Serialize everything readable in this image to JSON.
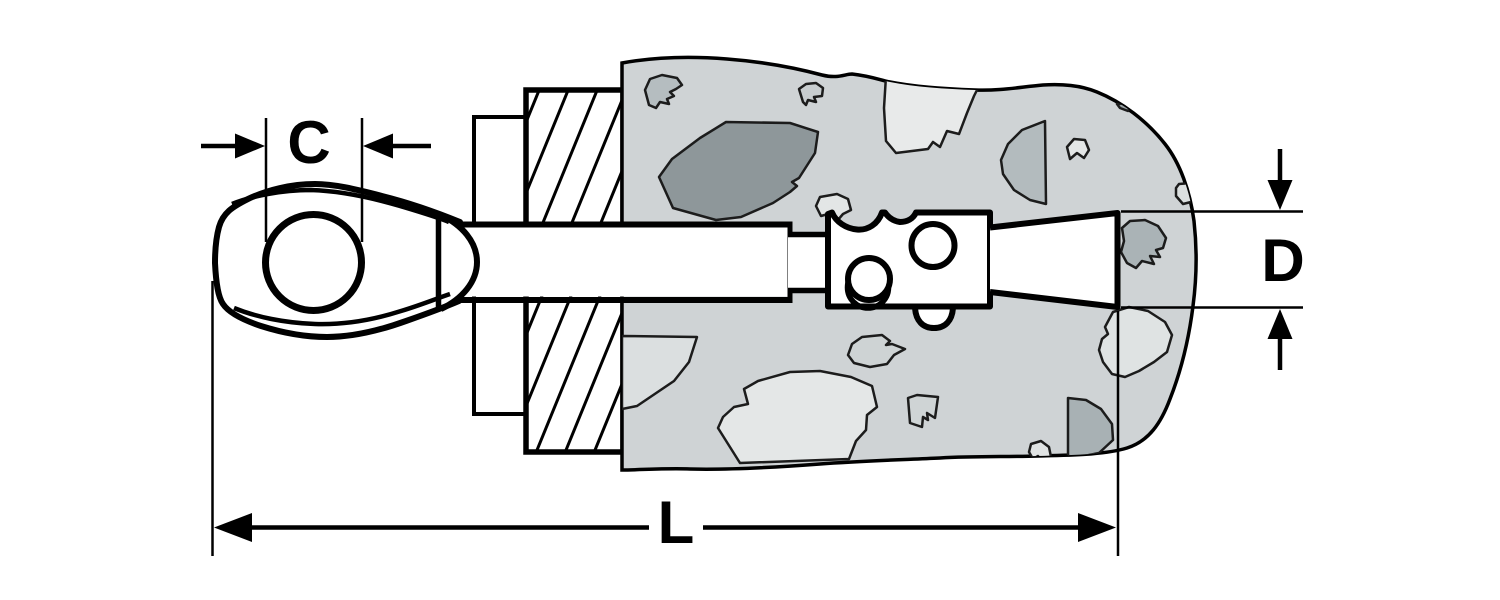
{
  "diagram": {
    "kind": "technical-dimension-drawing",
    "subject": "sleeve-anchor-with-eye-embedded-in-concrete",
    "dimensions": {
      "c": {
        "label": "C"
      },
      "d": {
        "label": "D"
      },
      "l": {
        "label": "L"
      }
    },
    "colors": {
      "background": "#ffffff",
      "outline": "#000000",
      "concrete": "#cfd3d5",
      "stone_dark": "#8e979a",
      "stone_medium": "#aab3b6",
      "stone_light": "#e6e8e8",
      "metal_fill": "#ffffff"
    },
    "icons": [
      "arrow-right-icon",
      "arrow-left-icon",
      "arrow-down-icon",
      "arrow-up-icon"
    ],
    "components": [
      "eye-head",
      "eye-hole",
      "threaded-shaft",
      "fixture-plate",
      "hatched-wall-section",
      "concrete-base",
      "aggregate-stones",
      "expansion-sleeve",
      "expander-wedge"
    ]
  }
}
